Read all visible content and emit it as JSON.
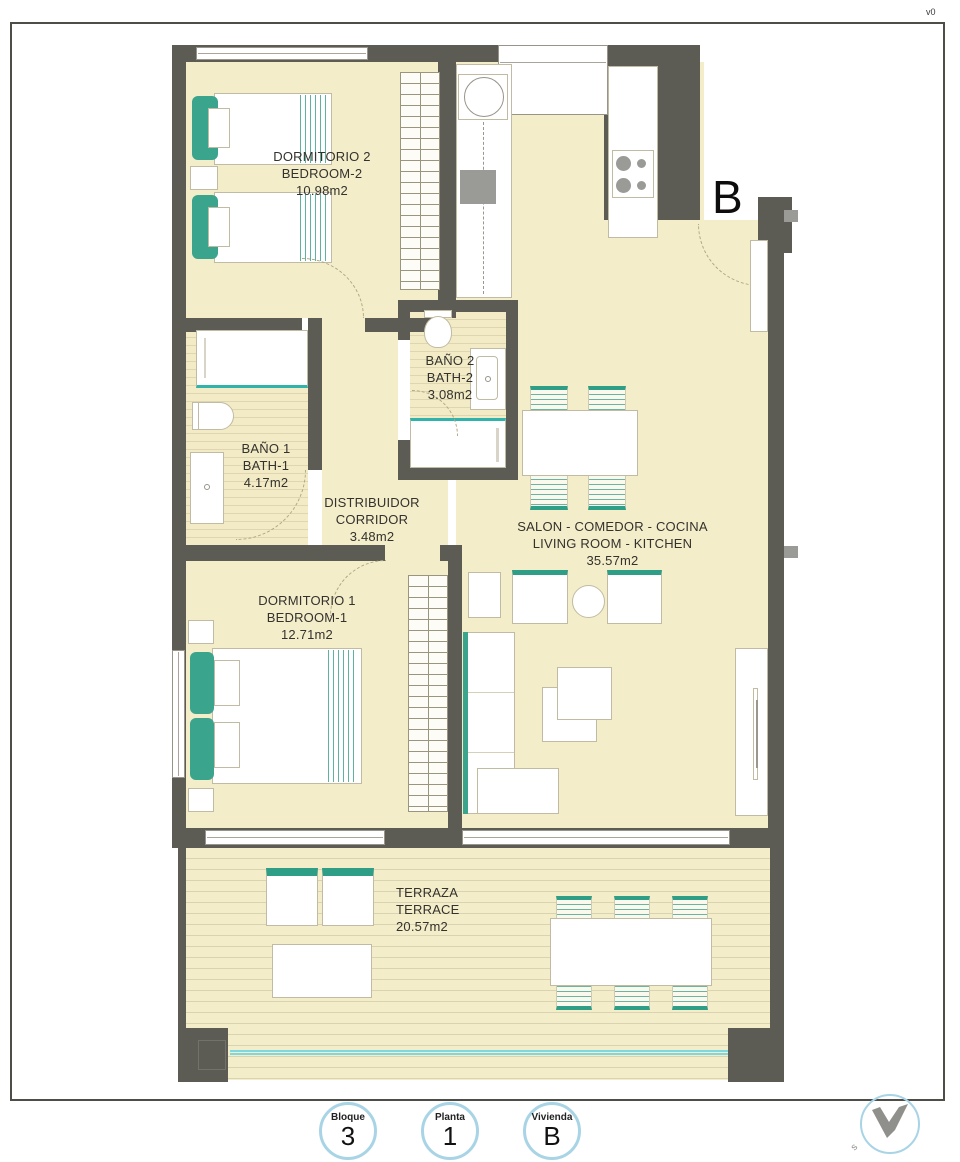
{
  "meta": {
    "version": "v0"
  },
  "plan": {
    "entrance_label": "B",
    "logo_letter": "s",
    "rooms": [
      {
        "id": "dormitorio2",
        "name_es": "DORMITORIO 2",
        "name_en": "BEDROOM-2",
        "area": "10.98m2"
      },
      {
        "id": "bano2",
        "name_es": "BAÑO 2",
        "name_en": "BATH-2",
        "area": "3.08m2"
      },
      {
        "id": "bano1",
        "name_es": "BAÑO 1",
        "name_en": "BATH-1",
        "area": "4.17m2"
      },
      {
        "id": "distribuidor",
        "name_es": "DISTRIBUIDOR",
        "name_en": "CORRIDOR",
        "area": "3.48m2"
      },
      {
        "id": "salon",
        "name_es": "SALON - COMEDOR - COCINA",
        "name_en": "LIVING ROOM - KITCHEN",
        "area": "35.57m2"
      },
      {
        "id": "dormitorio1",
        "name_es": "DORMITORIO 1",
        "name_en": "BEDROOM-1",
        "area": "12.71m2"
      },
      {
        "id": "terraza",
        "name_es": "TERRAZA",
        "name_en": "TERRACE",
        "area": "20.57m2"
      }
    ],
    "badges": [
      {
        "label": "Bloque",
        "value": "3"
      },
      {
        "label": "Planta",
        "value": "1"
      },
      {
        "label": "Vivienda",
        "value": "B"
      }
    ],
    "colors": {
      "wall": "#5c5b54",
      "floor": "#f4edca",
      "accent_teal": "#3aa48c",
      "glass_blue": "#7fd8e0",
      "badge_ring": "#a8d4e6"
    }
  }
}
